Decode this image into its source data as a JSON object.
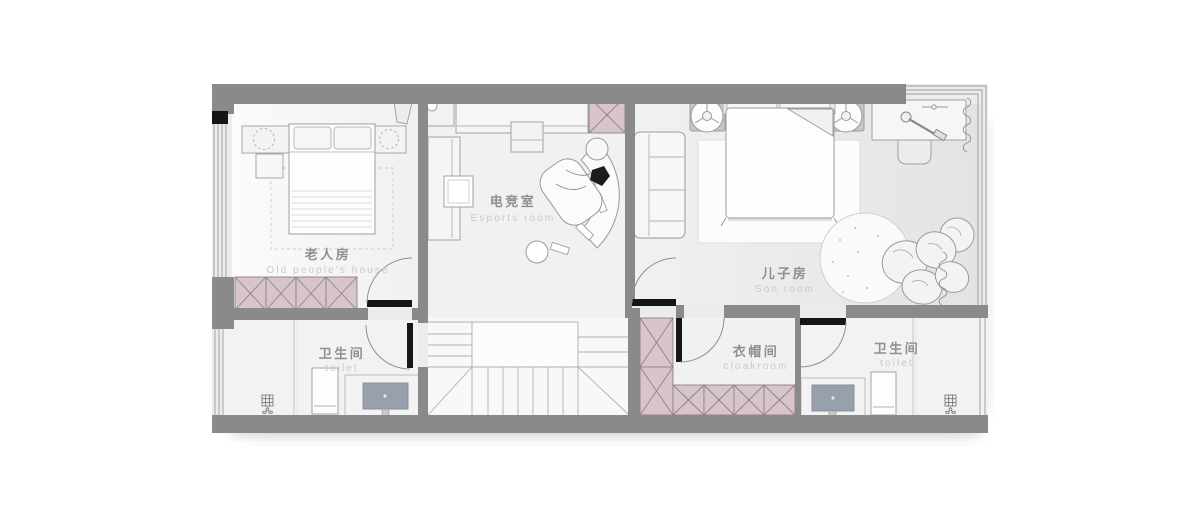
{
  "rooms": [
    {
      "id": "old-people-room",
      "zh": "老人房",
      "en": "Old people's house"
    },
    {
      "id": "esports-room",
      "zh": "电竞室",
      "en": "Esports room"
    },
    {
      "id": "son-room",
      "zh": "儿子房",
      "en": "Son room"
    },
    {
      "id": "toilet-left",
      "zh": "卫生间",
      "en": "toilet"
    },
    {
      "id": "cloakroom",
      "zh": "衣帽间",
      "en": "cloakroom"
    },
    {
      "id": "toilet-right",
      "zh": "卫生间",
      "en": "toilet"
    }
  ],
  "icons": {
    "floor_drain": "▦",
    "curtain": "∿"
  },
  "colors": {
    "wall": "#8a8a8a",
    "cabinet_pink": "#d7c5ca",
    "cabinet_line": "#8f8186",
    "door_leaf": "#161616",
    "label_zh": "#8f8f8f",
    "label_en": "#c9c9c9",
    "mirror": "#99a0ad",
    "floor": "#f1f1f1"
  }
}
